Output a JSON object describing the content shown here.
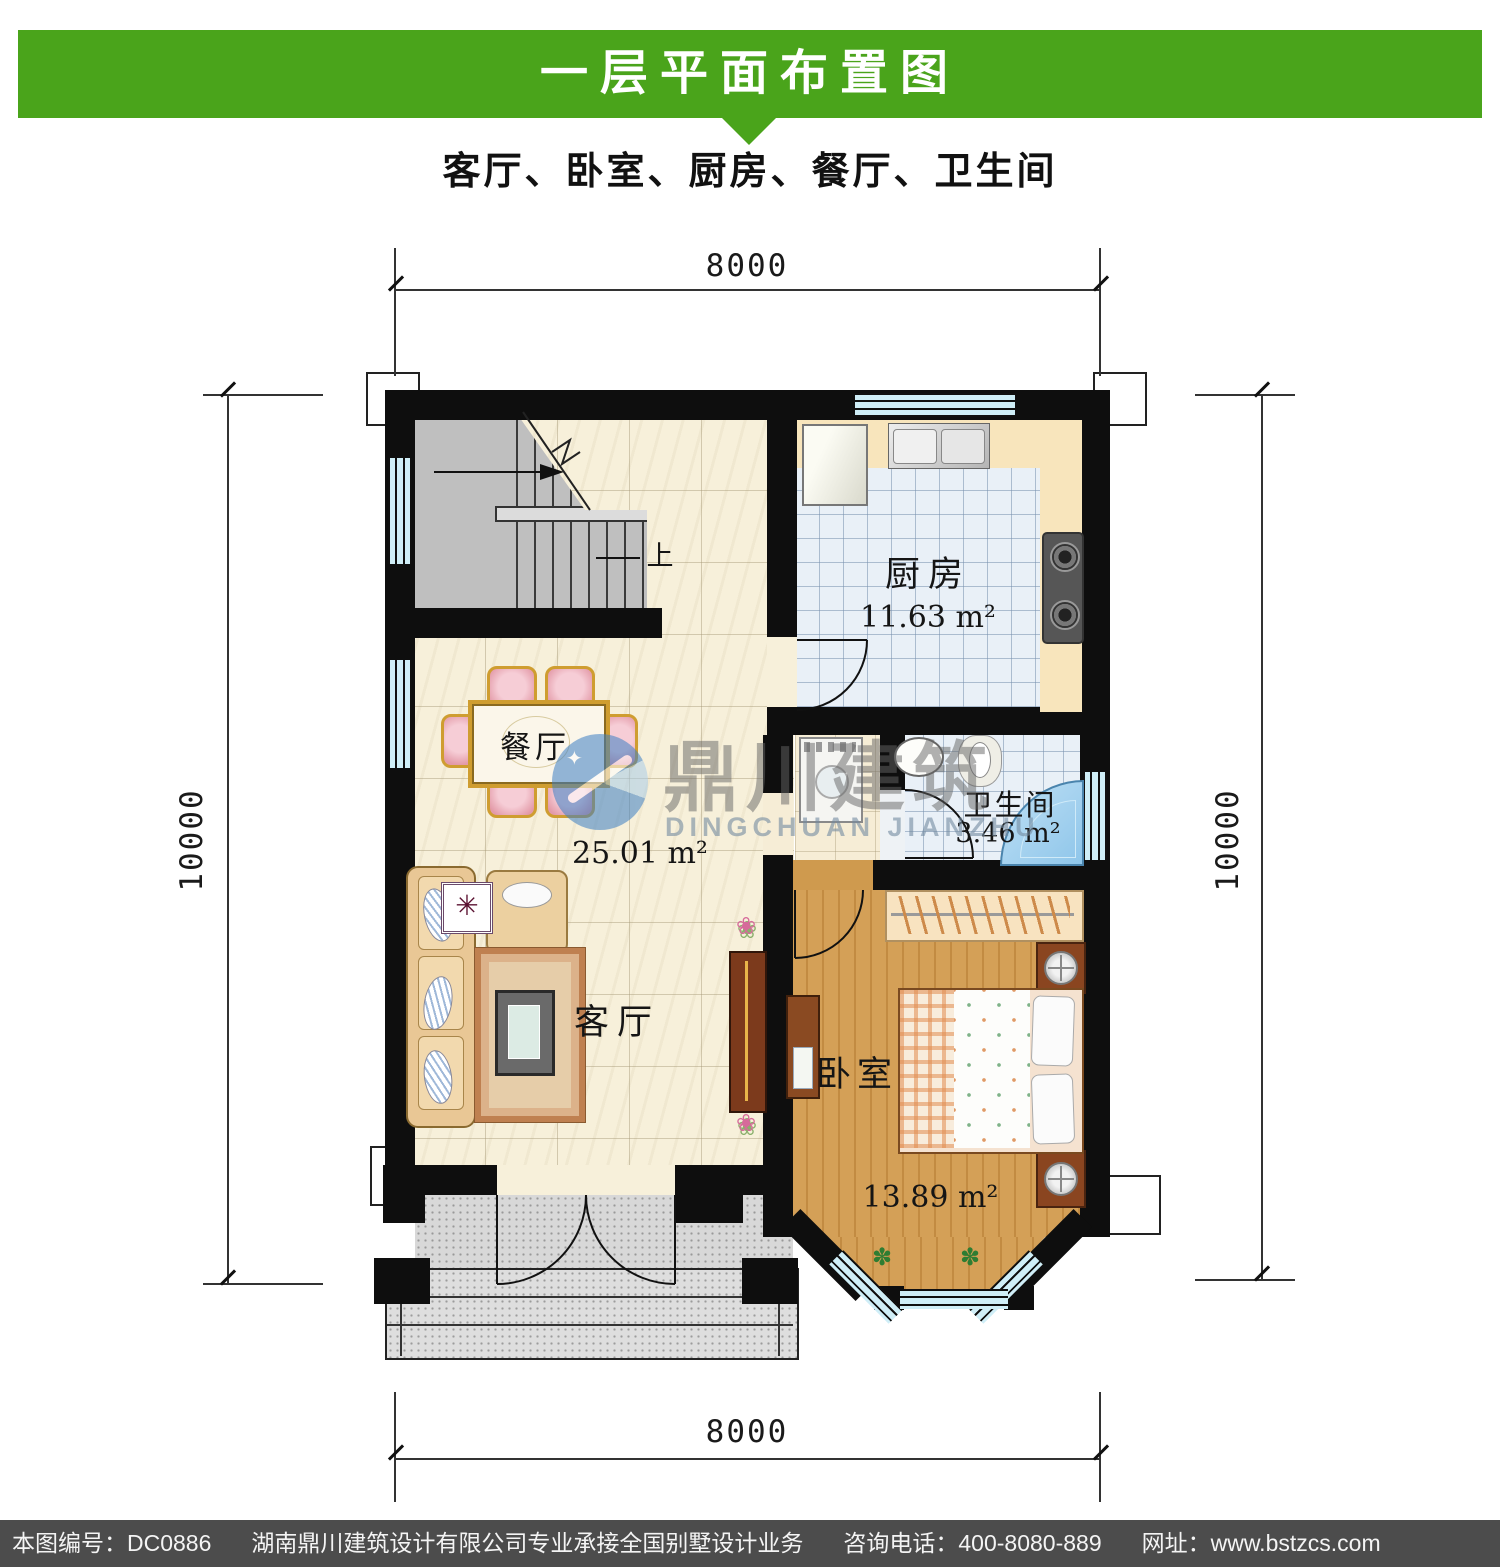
{
  "title_bar": {
    "text": "一层平面布置图"
  },
  "subtitle": "客厅、卧室、厨房、餐厅、卫生间",
  "dimensions": {
    "top": "8000",
    "bottom": "8000",
    "left": "10000",
    "right": "10000"
  },
  "rooms": {
    "kitchen": {
      "name": "厨房",
      "area": "11.63 m²"
    },
    "bathroom": {
      "name": "卫生间",
      "area": "3.46 m²"
    },
    "dining": {
      "name": "餐厅"
    },
    "living": {
      "name": "客厅"
    },
    "living_dining_area": "25.01 m²",
    "bedroom": {
      "name": "卧室",
      "area": "13.89 m²"
    },
    "stair": {
      "up": "上"
    }
  },
  "watermark": {
    "cn": "鼎川建筑",
    "en": "DINGCHUAN JIANZHU"
  },
  "footer": {
    "drawing_no": "本图编号：DC0886",
    "company": "湖南鼎川建筑设计有限公司专业承接全国别墅设计业务",
    "phone": "咨询电话：400-8080-889",
    "website": "网址：www.bstzcs.com"
  },
  "colors": {
    "header_green": "#4aa41b",
    "footer_gray": "#4c4c4c",
    "wall_black": "#0e0e0e",
    "window_blue": "#cfeef7",
    "wood": "#cf9a4e",
    "tile_blue": "#e9f0f7",
    "marble_cream": "#f7f0da"
  }
}
